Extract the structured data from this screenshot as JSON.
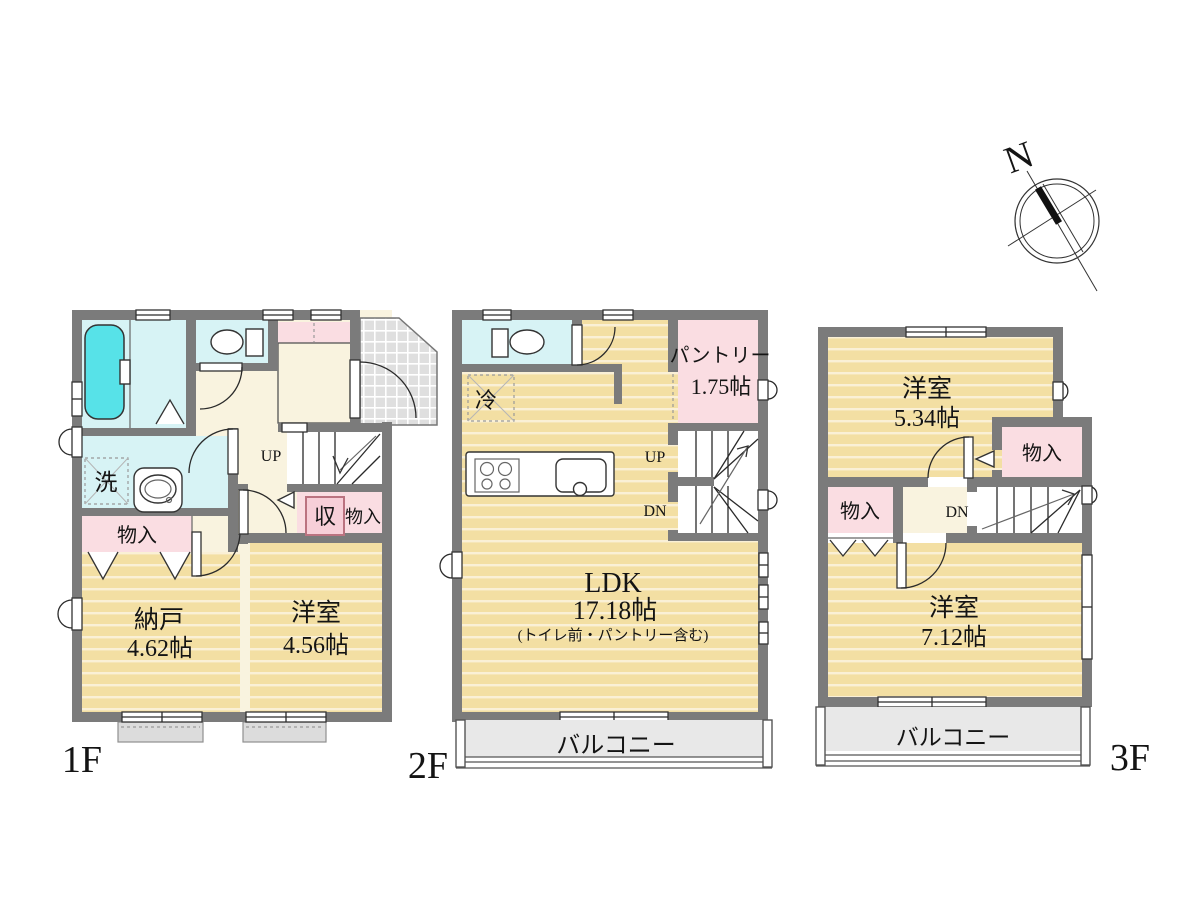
{
  "colors": {
    "wall": "#7b7b7b",
    "room_floor_tan": "#f3dfa3",
    "hall_floor_cream": "#f9f3df",
    "closet_pink": "#fadde2",
    "wet_area_cyan": "#d7f3f5",
    "bathtub_cyan": "#57e2e8",
    "tile_gray": "#dfdfdf",
    "balcony_gray": "#e8e8e8"
  },
  "floors": {
    "f1": {
      "label": "1F",
      "up_label": "UP",
      "laundry_label": "洗",
      "storage_left": "物入",
      "storage_symbol": "収",
      "storage_mid": "物入",
      "nando": {
        "name": "納戸",
        "size": "4.62帖"
      },
      "bedroom": {
        "name": "洋室",
        "size": "4.56帖"
      }
    },
    "f2": {
      "label": "2F",
      "fridge_label": "冷",
      "pantry": {
        "name": "パントリー",
        "size": "1.75帖"
      },
      "up_label": "UP",
      "dn_label": "DN",
      "ldk": {
        "name": "LDK",
        "size": "17.18帖",
        "note": "(トイレ前・パントリー含む)"
      },
      "balcony_label": "バルコニー"
    },
    "f3": {
      "label": "3F",
      "bedroom_upper": {
        "name": "洋室",
        "size": "5.34帖"
      },
      "storage_right": "物入",
      "storage_left": "物入",
      "dn_label": "DN",
      "bedroom_lower": {
        "name": "洋室",
        "size": "7.12帖"
      },
      "balcony_label": "バルコニー"
    }
  },
  "compass": {
    "north_label": "N"
  }
}
